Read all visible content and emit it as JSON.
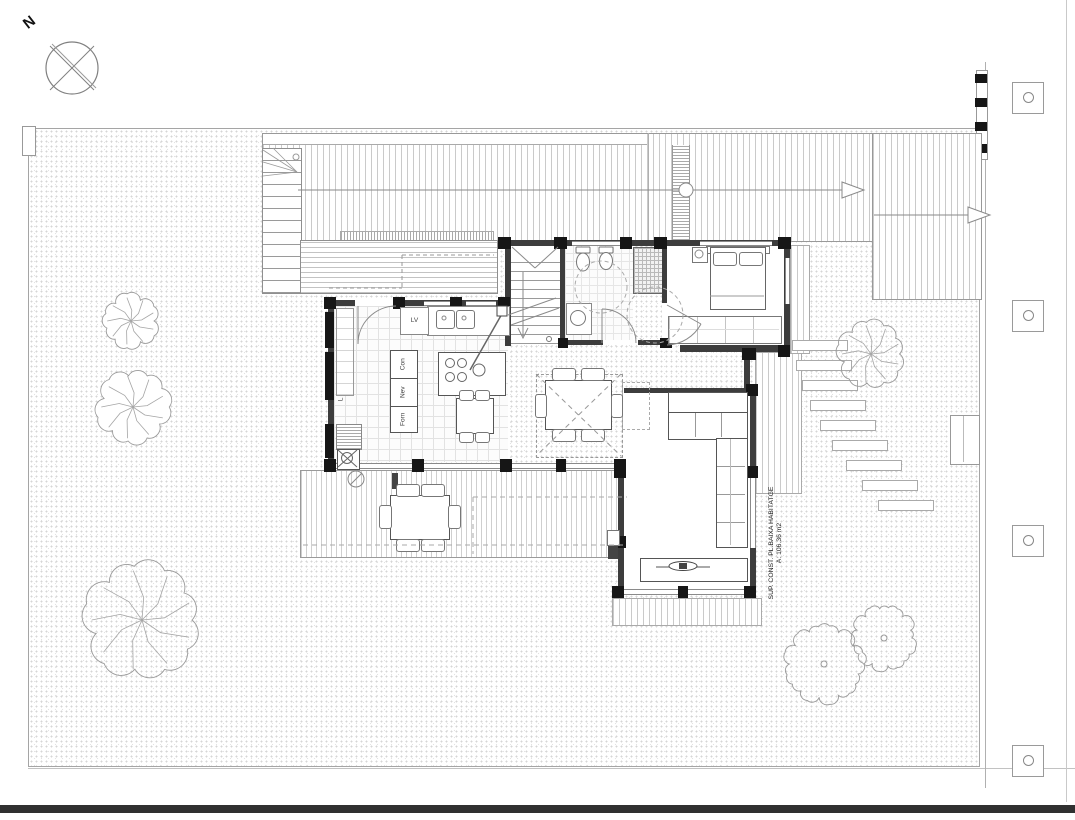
{
  "document": {
    "type": "Architectural ground-floor site plan"
  },
  "compass": {
    "north_label": "N"
  },
  "kitchen": {
    "dishwasher_label": "LV",
    "tall_units": [
      "Con",
      "Nev",
      "Forn"
    ],
    "pantry_label": "L"
  },
  "annotations": {
    "area_label_line1": "SUP. CONST. PL.BAIXA HABITATGE",
    "area_label_line2": "A: 106.36 m2"
  },
  "colors": {
    "wall": "#3d3d3d",
    "column": "#161616",
    "line": "#9a9a9a",
    "street_edge": "#303030"
  }
}
